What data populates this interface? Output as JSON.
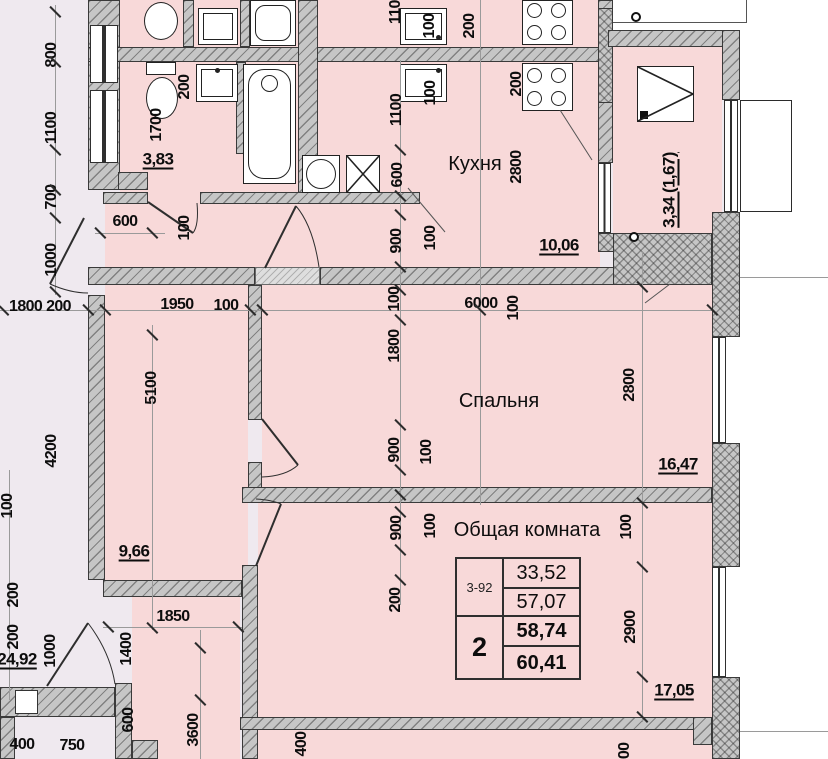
{
  "title": "Floor plan — 2-room apartment 3-92",
  "colors": {
    "room_fill": "#f8d9d9",
    "outside_fill": "#efe9ef",
    "wall_fill": "#c6c6c6"
  },
  "table": {
    "code": "3-92",
    "rooms_count": "2",
    "living_area": "33,52",
    "area_wo_balcony": "57,07",
    "total_area": "58,74",
    "total_with_balcony": "60,41"
  },
  "labels": [
    {
      "t": "Кухня",
      "x": 475,
      "y": 164,
      "c": "room"
    },
    {
      "t": "Спальня",
      "x": 499,
      "y": 401,
      "c": "room"
    },
    {
      "t": "Общая комната",
      "x": 527,
      "y": 530,
      "c": "room"
    },
    {
      "t": "3,83",
      "x": 158,
      "y": 159,
      "c": "area"
    },
    {
      "t": "10,06",
      "x": 559,
      "y": 245,
      "c": "area"
    },
    {
      "t": "16,47",
      "x": 678,
      "y": 464,
      "c": "area"
    },
    {
      "t": "17,05",
      "x": 674,
      "y": 690,
      "c": "area"
    },
    {
      "t": "9,66",
      "x": 134,
      "y": 551,
      "c": "area"
    },
    {
      "t": "24,92",
      "x": 17,
      "y": 659,
      "c": "area"
    },
    {
      "t": "3,34 (1,67)",
      "x": 669,
      "y": 190,
      "r": 1,
      "c": "area"
    },
    {
      "t": "800",
      "x": 52,
      "y": 55,
      "r": 1
    },
    {
      "t": "1100",
      "x": 52,
      "y": 128,
      "r": 1
    },
    {
      "t": "700",
      "x": 52,
      "y": 197,
      "r": 1
    },
    {
      "t": "1000",
      "x": 52,
      "y": 260,
      "r": 1
    },
    {
      "t": "4200",
      "x": 52,
      "y": 451,
      "r": 1
    },
    {
      "t": "100",
      "x": 8,
      "y": 506,
      "r": 1
    },
    {
      "t": "200",
      "x": 14,
      "y": 595,
      "r": 1
    },
    {
      "t": "200",
      "x": 14,
      "y": 637,
      "r": 1
    },
    {
      "t": "1000",
      "x": 51,
      "y": 651,
      "r": 1
    },
    {
      "t": "1800 200",
      "x": 40,
      "y": 307
    },
    {
      "t": "1950",
      "x": 177,
      "y": 305
    },
    {
      "t": "100",
      "x": 226,
      "y": 306
    },
    {
      "t": "5100",
      "x": 152,
      "y": 388,
      "r": 1
    },
    {
      "t": "1700",
      "x": 157,
      "y": 125,
      "r": 1
    },
    {
      "t": "200",
      "x": 185,
      "y": 87,
      "r": 1
    },
    {
      "t": "600",
      "x": 125,
      "y": 222
    },
    {
      "t": "100",
      "x": 185,
      "y": 228,
      "r": 1
    },
    {
      "t": "1100",
      "x": 396,
      "y": 8,
      "r": 1
    },
    {
      "t": "100",
      "x": 430,
      "y": 26,
      "r": 1
    },
    {
      "t": "200",
      "x": 470,
      "y": 26,
      "r": 1
    },
    {
      "t": "1100",
      "x": 397,
      "y": 110,
      "r": 1
    },
    {
      "t": "600",
      "x": 398,
      "y": 175,
      "r": 1
    },
    {
      "t": "900",
      "x": 397,
      "y": 241,
      "r": 1
    },
    {
      "t": "100",
      "x": 431,
      "y": 93,
      "r": 1
    },
    {
      "t": "100",
      "x": 431,
      "y": 238,
      "r": 1
    },
    {
      "t": "200",
      "x": 517,
      "y": 84,
      "r": 1
    },
    {
      "t": "2800",
      "x": 517,
      "y": 167,
      "r": 1
    },
    {
      "t": "100",
      "x": 395,
      "y": 299,
      "r": 1
    },
    {
      "t": "1800",
      "x": 395,
      "y": 346,
      "r": 1
    },
    {
      "t": "900",
      "x": 395,
      "y": 450,
      "r": 1
    },
    {
      "t": "100",
      "x": 427,
      "y": 452,
      "r": 1
    },
    {
      "t": "6000",
      "x": 481,
      "y": 304
    },
    {
      "t": "100",
      "x": 514,
      "y": 308,
      "r": 1
    },
    {
      "t": "2800",
      "x": 630,
      "y": 385,
      "r": 1
    },
    {
      "t": "900",
      "x": 397,
      "y": 528,
      "r": 1
    },
    {
      "t": "100",
      "x": 431,
      "y": 526,
      "r": 1
    },
    {
      "t": "200",
      "x": 396,
      "y": 600,
      "r": 1
    },
    {
      "t": "100",
      "x": 627,
      "y": 527,
      "r": 1
    },
    {
      "t": "2900",
      "x": 631,
      "y": 627,
      "r": 1
    },
    {
      "t": "1850",
      "x": 173,
      "y": 617
    },
    {
      "t": "1400",
      "x": 127,
      "y": 649,
      "r": 1
    },
    {
      "t": "600",
      "x": 129,
      "y": 720,
      "r": 1
    },
    {
      "t": "3600",
      "x": 194,
      "y": 730,
      "r": 1
    },
    {
      "t": "400",
      "x": 22,
      "y": 745
    },
    {
      "t": "750",
      "x": 72,
      "y": 746
    },
    {
      "t": "400",
      "x": 302,
      "y": 744,
      "r": 1
    },
    {
      "t": "100",
      "x": 625,
      "y": 755,
      "r": 1
    }
  ]
}
